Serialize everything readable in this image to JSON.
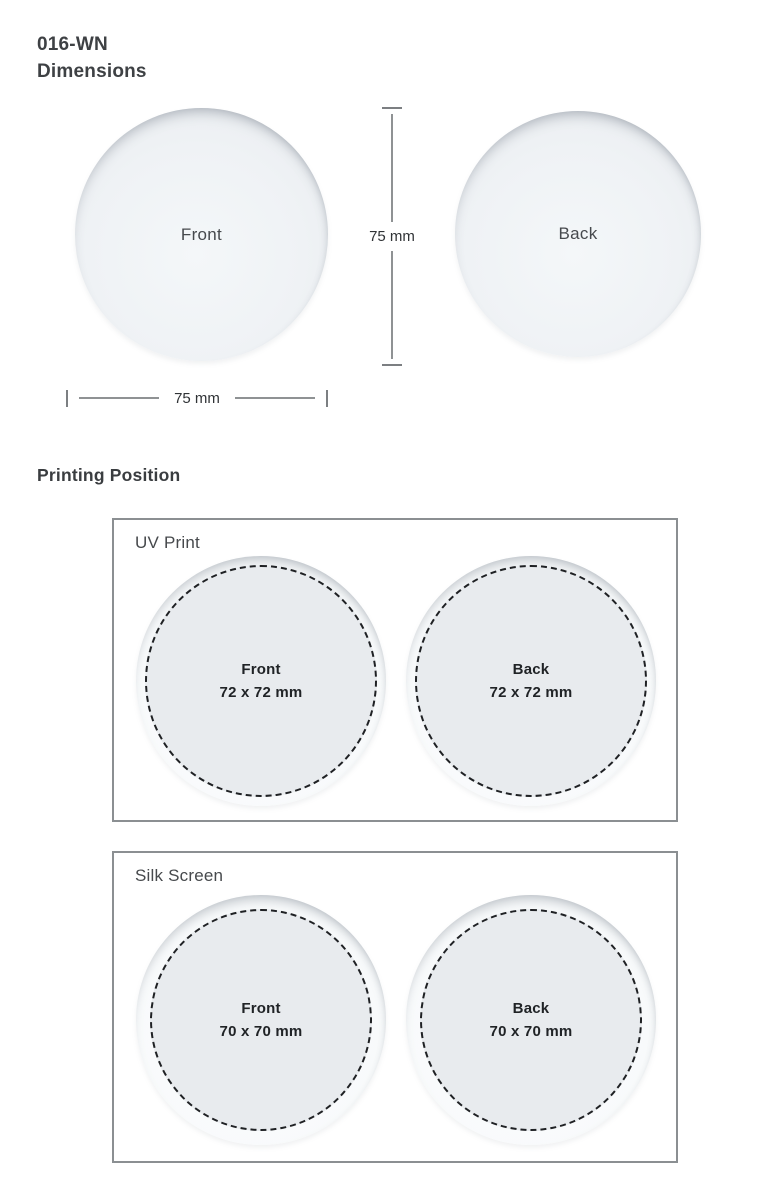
{
  "header": {
    "product_code": "016-WN",
    "section_title": "Dimensions"
  },
  "dimensions": {
    "front_label": "Front",
    "back_label": "Back",
    "height_label": "75 mm",
    "width_label": "75 mm"
  },
  "printing": {
    "heading": "Printing Position",
    "panels": [
      {
        "title": "UV Print",
        "areas": [
          {
            "label": "Front",
            "size": "72 x 72 mm"
          },
          {
            "label": "Back",
            "size": "72 x 72 mm"
          }
        ]
      },
      {
        "title": "Silk Screen",
        "areas": [
          {
            "label": "Front",
            "size": "70 x 70 mm"
          },
          {
            "label": "Back",
            "size": "70 x 70 mm"
          }
        ]
      }
    ]
  },
  "colors": {
    "background": "#ffffff",
    "disc_fill": "#edf0f3",
    "print_area_fill": "#e8ebee",
    "panel_border": "#8b8f92",
    "dash_line": "#1f2124",
    "dimension_line": "#8f9294",
    "heading_text": "#3e4144",
    "body_text": "#202326"
  }
}
